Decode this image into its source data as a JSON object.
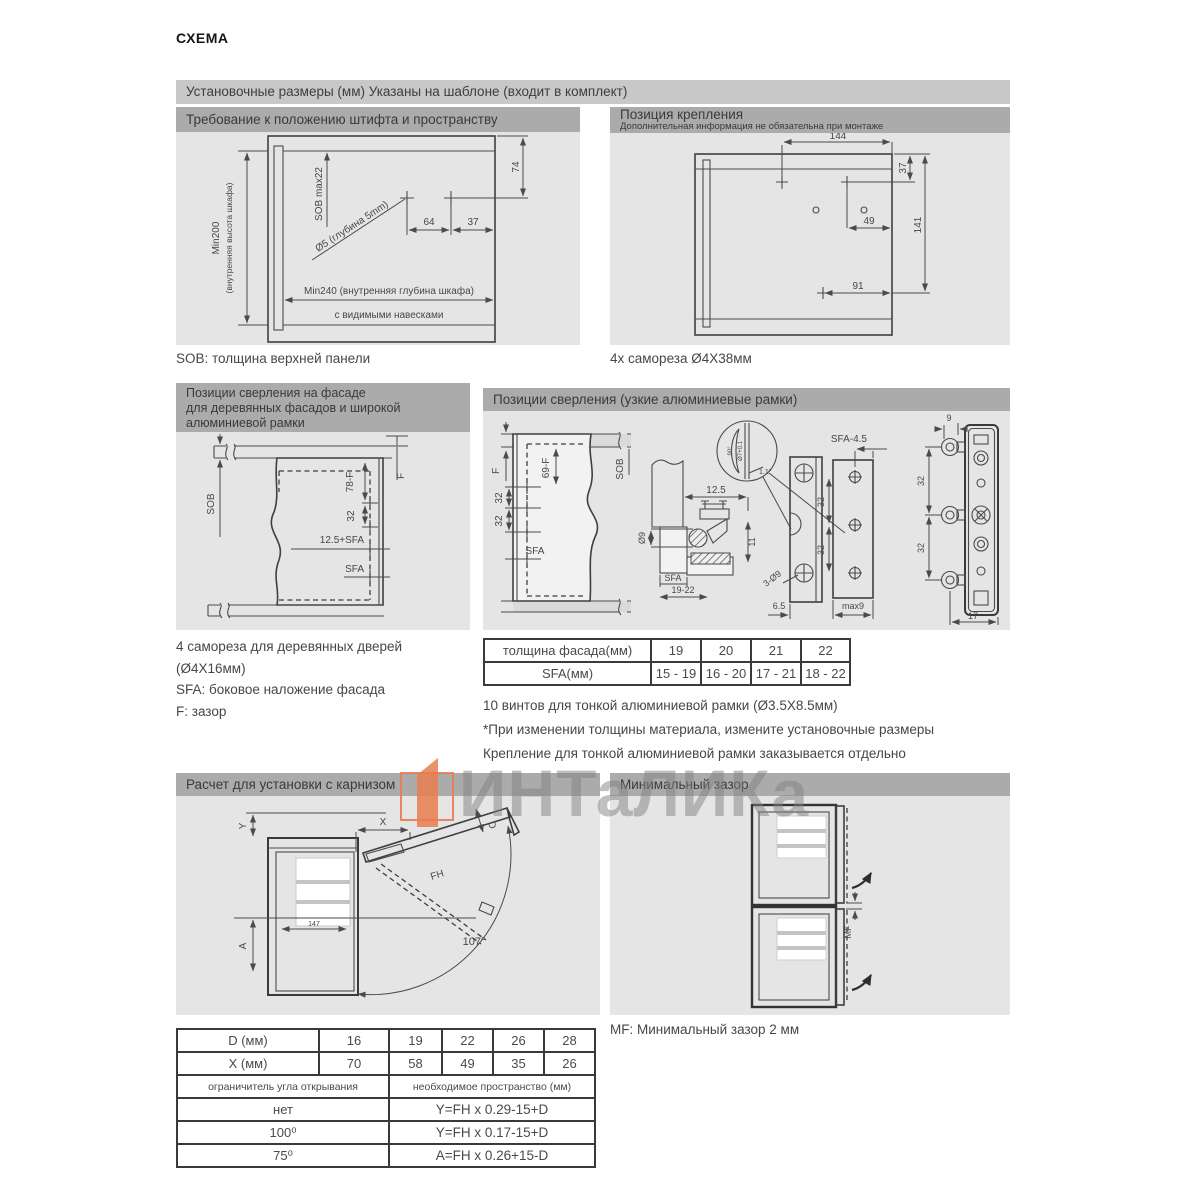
{
  "page": {
    "title": "СХЕМА"
  },
  "banner": "Установочные размеры (мм)  Указаны на шаблоне (входит в комплект)",
  "panelA": {
    "header": "Требование к положению штифта и пространству",
    "caption": "SOB: толщина верхней панели",
    "labels": {
      "min200": "Min200",
      "min200b": "(внутренняя высота шкафа)",
      "sob": "SOB max22",
      "dia": "Ø5 (глубина 5mm)",
      "d64": "64",
      "d37": "37",
      "d74": "74",
      "min240": "Min240 (внутренняя глубина шкафа)",
      "hinges": "с видимыми навесками"
    }
  },
  "panelB": {
    "header": "Позиция крепления",
    "sub": "Дополнительная информация не обязательна при монтаже",
    "caption": "4x самореза  Ø4X38мм",
    "labels": {
      "d144": "144",
      "d37": "37",
      "d141": "141",
      "d49": "49",
      "d91": "91"
    }
  },
  "panelC": {
    "header_lines": [
      "Позиции сверления на фасаде",
      "для деревянных фасадов и широкой",
      "алюминиевой рамки"
    ],
    "caption_lines": [
      "4 самореза для деревянных дверей",
      "(Ø4X16мм)",
      "SFA: боковое наложение фасада",
      "F: зазор"
    ],
    "labels": {
      "sob": "SOB",
      "f": "F",
      "v78f": "78-F",
      "v32": "32",
      "sfa125": "12.5+SFA",
      "sfa": "SFA"
    }
  },
  "panelD": {
    "header": "Позиции сверления (узкие алюминиевые рамки)",
    "labels": {
      "f": "F",
      "v69f": "69-F",
      "sob": "SOB",
      "v32a": "32",
      "v32b": "32",
      "sfa1": "SFA",
      "d125": "12.5",
      "dia9": "Ø9",
      "d11": "11",
      "sfa2": "SFA",
      "r1922": "19-22",
      "deg90": "90°",
      "dia7": "Ø7+0.1",
      "a11": "1.1°",
      "sfa45": "SFA-4.5",
      "v32c": "32",
      "v32d": "32",
      "holes": "3-Ø9",
      "d65": "6.5",
      "max9": "max9",
      "n9": "9",
      "v32e": "32",
      "v32f": "32",
      "d17": "17"
    }
  },
  "tables": {
    "mid": {
      "r0": [
        "толщина фасада(мм)",
        "19",
        "20",
        "21",
        "22"
      ],
      "r1": [
        "SFA(мм)",
        "15 - 19",
        "16 - 20",
        "17 - 21",
        "18 - 22"
      ]
    },
    "bottom": {
      "r0": [
        "D (мм)",
        "16",
        "19",
        "22",
        "26",
        "28"
      ],
      "r1": [
        "X (мм)",
        "70",
        "58",
        "49",
        "35",
        "26"
      ],
      "h_left": "ограничитель угла открывания",
      "h_right": "необходимое пространство (мм)",
      "rows": [
        [
          "нет",
          "Y=FH x 0.29-15+D"
        ],
        [
          "100⁰",
          "Y=FH x 0.17-15+D"
        ],
        [
          "75⁰",
          "A=FH x 0.26+15-D"
        ]
      ]
    }
  },
  "notes": [
    "10 винтов для тонкой алюминиевой  рамки (Ø3.5X8.5мм)",
    "*При изменении толщины материала, измените установочные размеры",
    "Крепление для тонкой алюминиевой рамки заказывается отдельно"
  ],
  "panelE": {
    "header": "Расчет для установки с карнизом",
    "labels": {
      "x": "X",
      "y": "Y",
      "d": "D",
      "fh": "FH",
      "a": "A",
      "angle": "107°",
      "d147": "147"
    }
  },
  "panelF": {
    "header": "Минимальный зазор",
    "caption": "MF: Минимальный зазор 2 мм",
    "labels": {
      "mf": "MF"
    }
  },
  "watermark": {
    "text": "ИНТаЛИКа"
  },
  "colors": {
    "accent_orange": "#e87c4e",
    "header_gray": "#ababab",
    "banner_gray": "#c8c8c8",
    "panel_gray": "#e5e5e5"
  }
}
